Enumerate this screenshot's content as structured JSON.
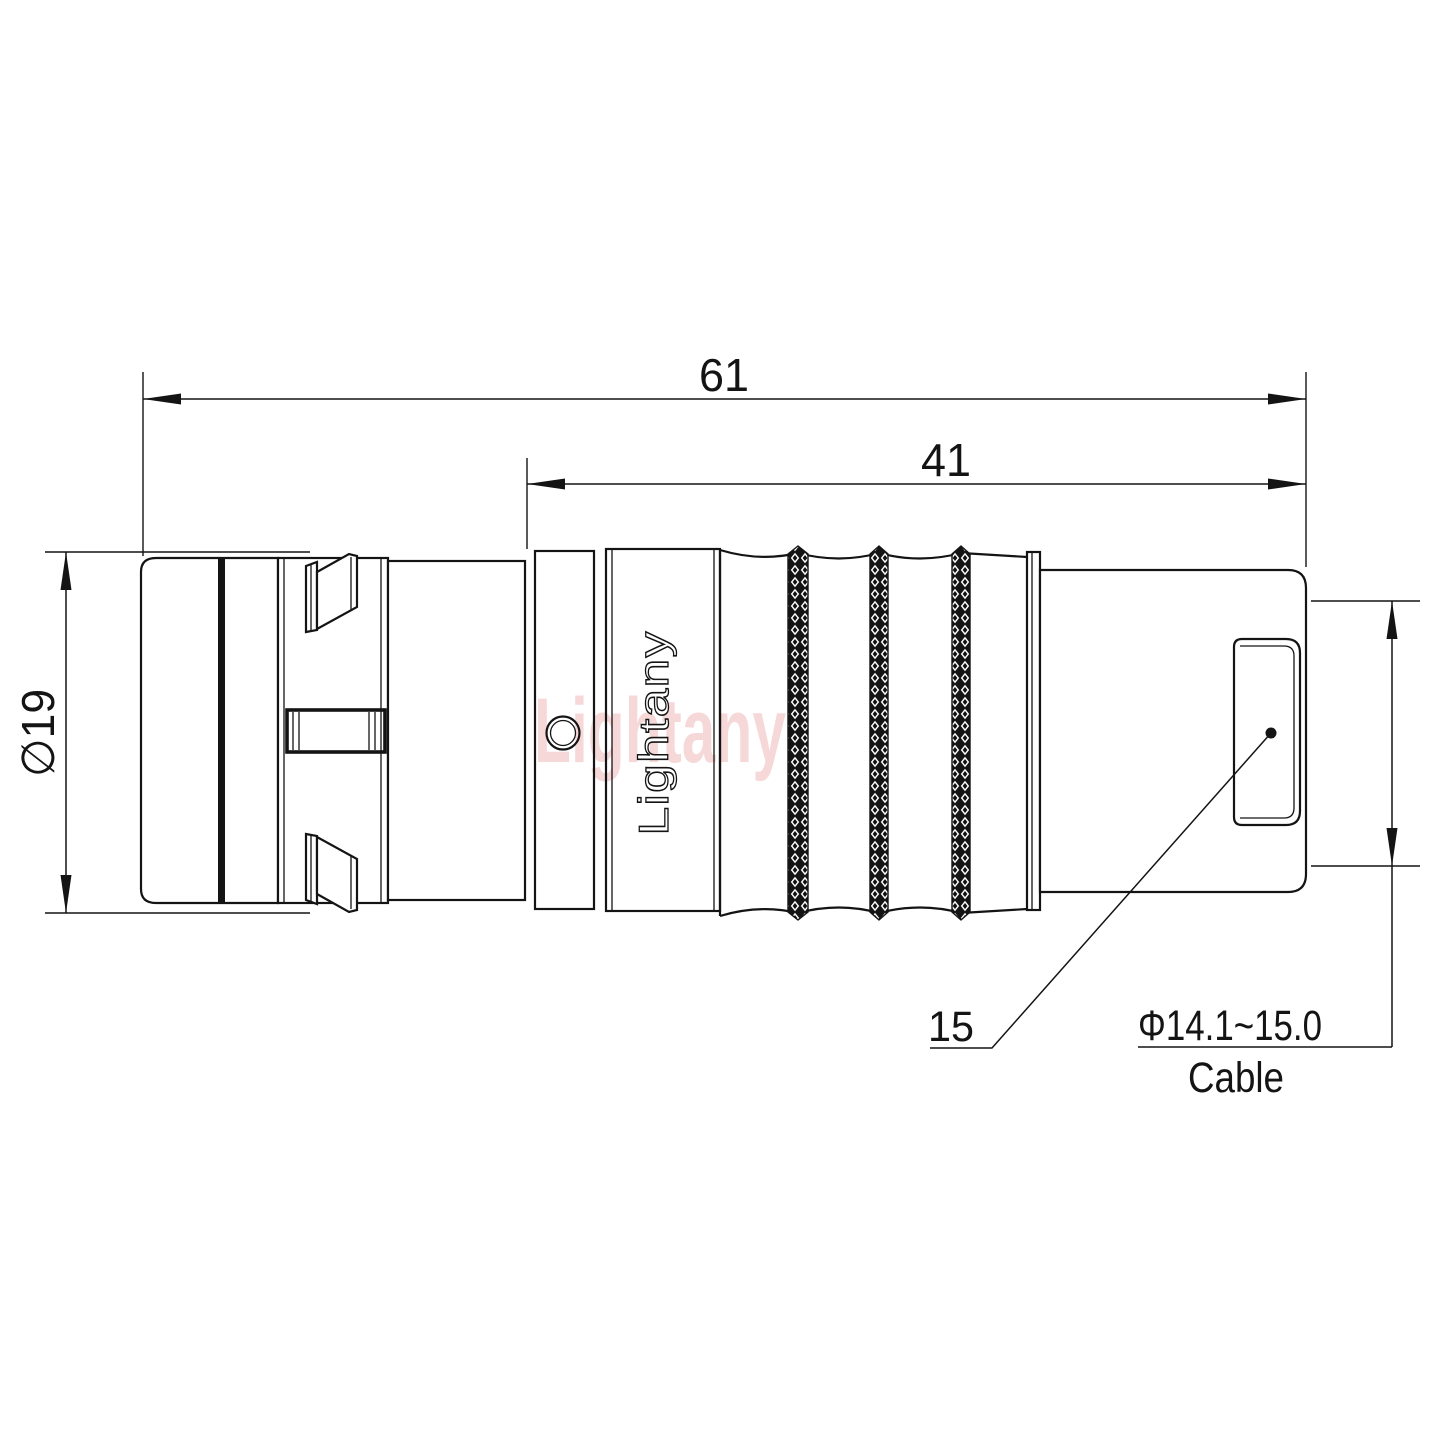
{
  "drawing": {
    "dimensions": {
      "overall_length": "61",
      "front_length": "41",
      "body_diameter": "∅19",
      "boot_length": "15",
      "cable_diameter_range": "Φ14.1~15.0",
      "cable_caption": "Cable"
    },
    "labels": {
      "body_logo": "Lightany",
      "watermark": "Lightany"
    },
    "colors": {
      "line": "#141414",
      "watermark": "#f0b9b9",
      "background": "#ffffff"
    }
  }
}
